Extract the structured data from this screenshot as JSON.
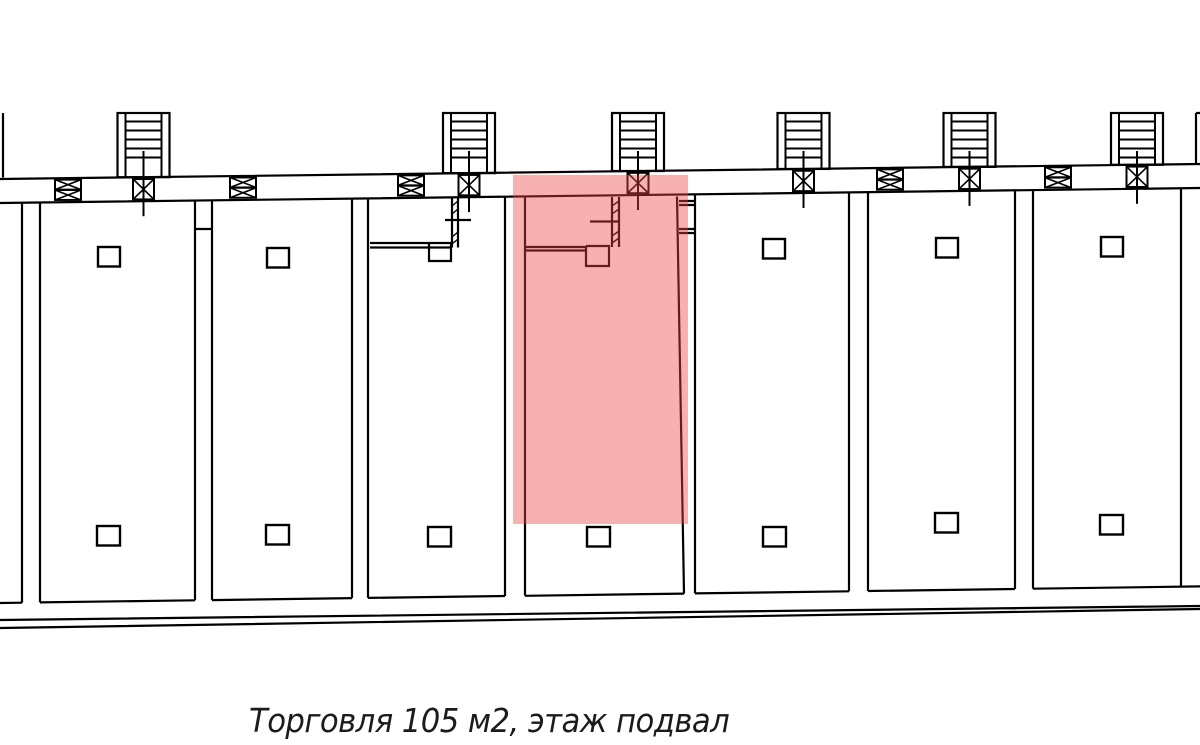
{
  "plan": {
    "caption": "Торговля 105 м2, этаж подвал",
    "listing_type": "Торговля",
    "area": "105 м2",
    "floor": "этаж подвал",
    "highlight_color": "#ef4444",
    "line_color": "#000000",
    "background_color": "#ffffff"
  }
}
